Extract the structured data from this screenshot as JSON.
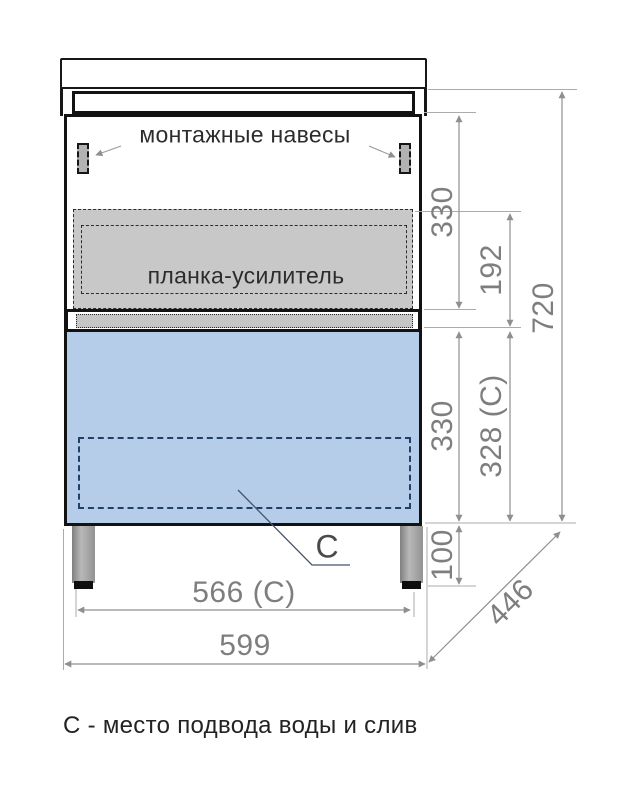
{
  "labels": {
    "mounting_brackets": "монтажные навесы",
    "reinforcement_bar": "планка-усилитель",
    "connection_letter": "С",
    "caption": "С - место подвода воды и слив"
  },
  "dimensions": {
    "upper_section_height": "330",
    "bar_to_rail_offset": "192",
    "cabinet_height": "720",
    "lower_section_height": "330",
    "drawer_opening_height": "328 (С)",
    "leg_height": "100",
    "inner_width": "566 (С)",
    "overall_width": "599",
    "depth": "446"
  },
  "colors": {
    "drawer_fill": "#b5cde8",
    "reinforcement_bar_fill": "#c8c8c8",
    "cutout_dash": "#20406a",
    "dimension_text": "#7e7e7e",
    "outline": "#121212"
  }
}
